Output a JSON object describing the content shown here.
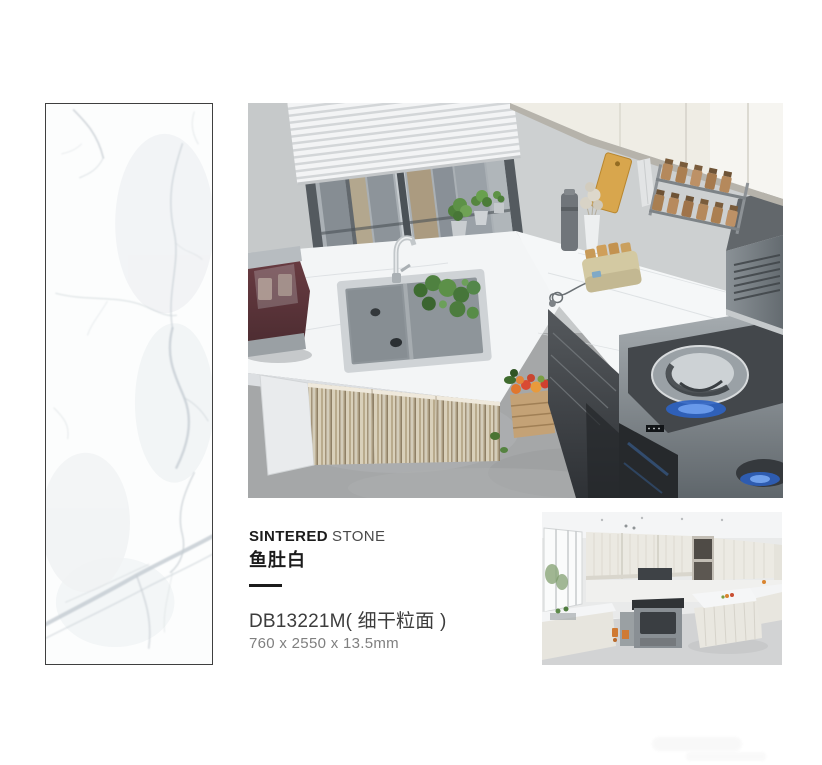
{
  "product": {
    "brand_line": {
      "bold": "SINTERED",
      "light": "STONE"
    },
    "name": "鱼肚白",
    "model": "DB13221M( 细干粒面 )",
    "dimensions": "760 x 2550 x 13.5mm"
  },
  "colors": {
    "page_bg": "#ffffff",
    "text_primary": "#1c1c1c",
    "text_secondary": "#4a4a4a",
    "text_muted": "#7f7f7f",
    "slab_base": "#fcfdfd",
    "slab_vein": "#c5cdd3",
    "slab_border": "#3f3f3f",
    "kitchen_wall": "#c6c9ca",
    "kitchen_counter": "#f3f5f6",
    "kitchen_floor": "#a5a7a8",
    "cabinet_wood": "#c9bda0",
    "stove_steel": "#8f979c",
    "flame_blue": "#2d63c4",
    "cutting_board": "#d8a64d",
    "spice_jar": "#b5895c"
  }
}
